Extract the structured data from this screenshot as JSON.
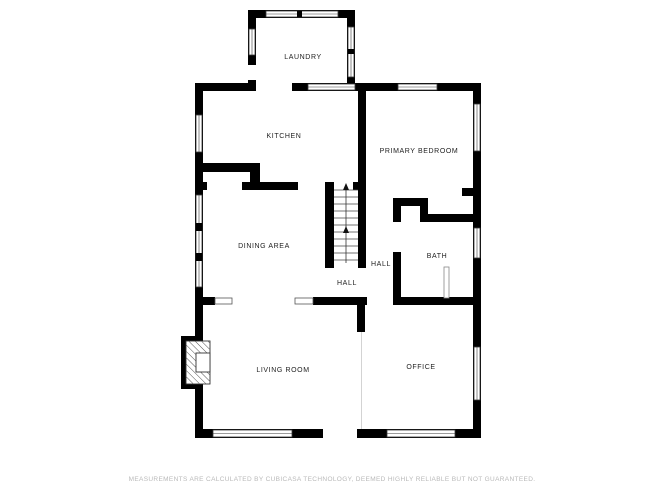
{
  "plan": {
    "rooms": {
      "laundry": "LAUNDRY",
      "kitchen": "KITCHEN",
      "primary_bedroom": "PRIMARY BEDROOM",
      "dining_area": "DINING AREA",
      "hall_upper": "HALL",
      "hall_lower": "HALL",
      "bath": "BATH",
      "living_room": "LIVING ROOM",
      "office": "OFFICE"
    },
    "features": {
      "stairs_direction": "up",
      "fireplace": "fireplace",
      "shower": "shower-glass"
    }
  },
  "footer": {
    "disclaimer": "MEASUREMENTS ARE CALCULATED BY CUBICASA TECHNOLOGY, DEEMED HIGHLY RELIABLE BUT NOT GUARANTEED."
  },
  "colors": {
    "background": "#ffffff",
    "wall": "#000000",
    "room_label": "#222222",
    "disclaimer_text": "#b9b9b9"
  }
}
